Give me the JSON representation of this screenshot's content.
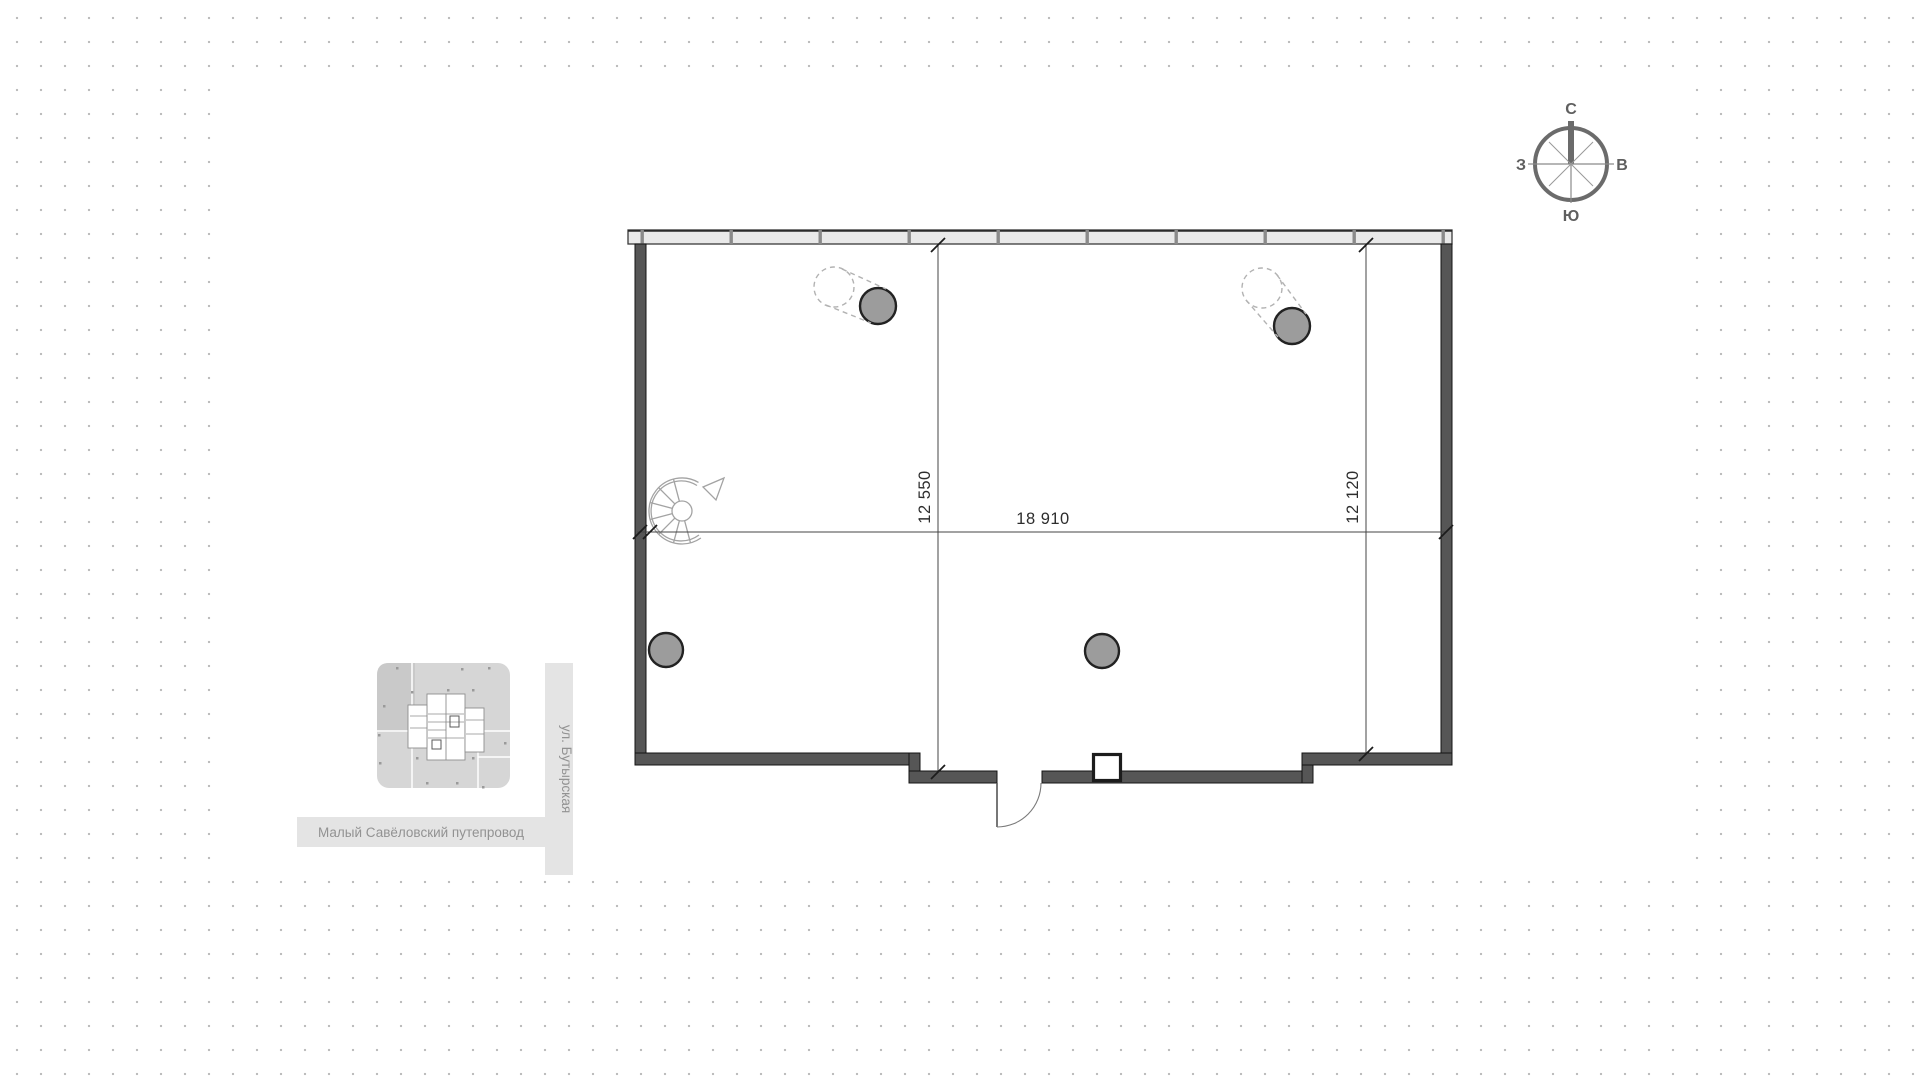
{
  "dims": {
    "width": "18 910",
    "left": "12 550",
    "right": "12 120"
  },
  "compass": {
    "north": "С",
    "east": "В",
    "south": "Ю",
    "west": "З"
  },
  "minimap": {
    "street_vertical": "ул. Бутырская",
    "street_horizontal": "Малый Савёловский путепровод"
  },
  "colors": {
    "wall_fill": "#565656",
    "curtain_band_fill": "#e9e9e9",
    "column_fill": "#9c9c9c",
    "ghost_stroke": "#b2b2b2",
    "dim_line": "#444444",
    "background_dot": "#bdbdbd",
    "minimap_block_fill": "#d6d6d6",
    "street_band_fill": "#e4e4e4",
    "street_text": "#929292",
    "compass_stroke": "#6b6b6b"
  }
}
